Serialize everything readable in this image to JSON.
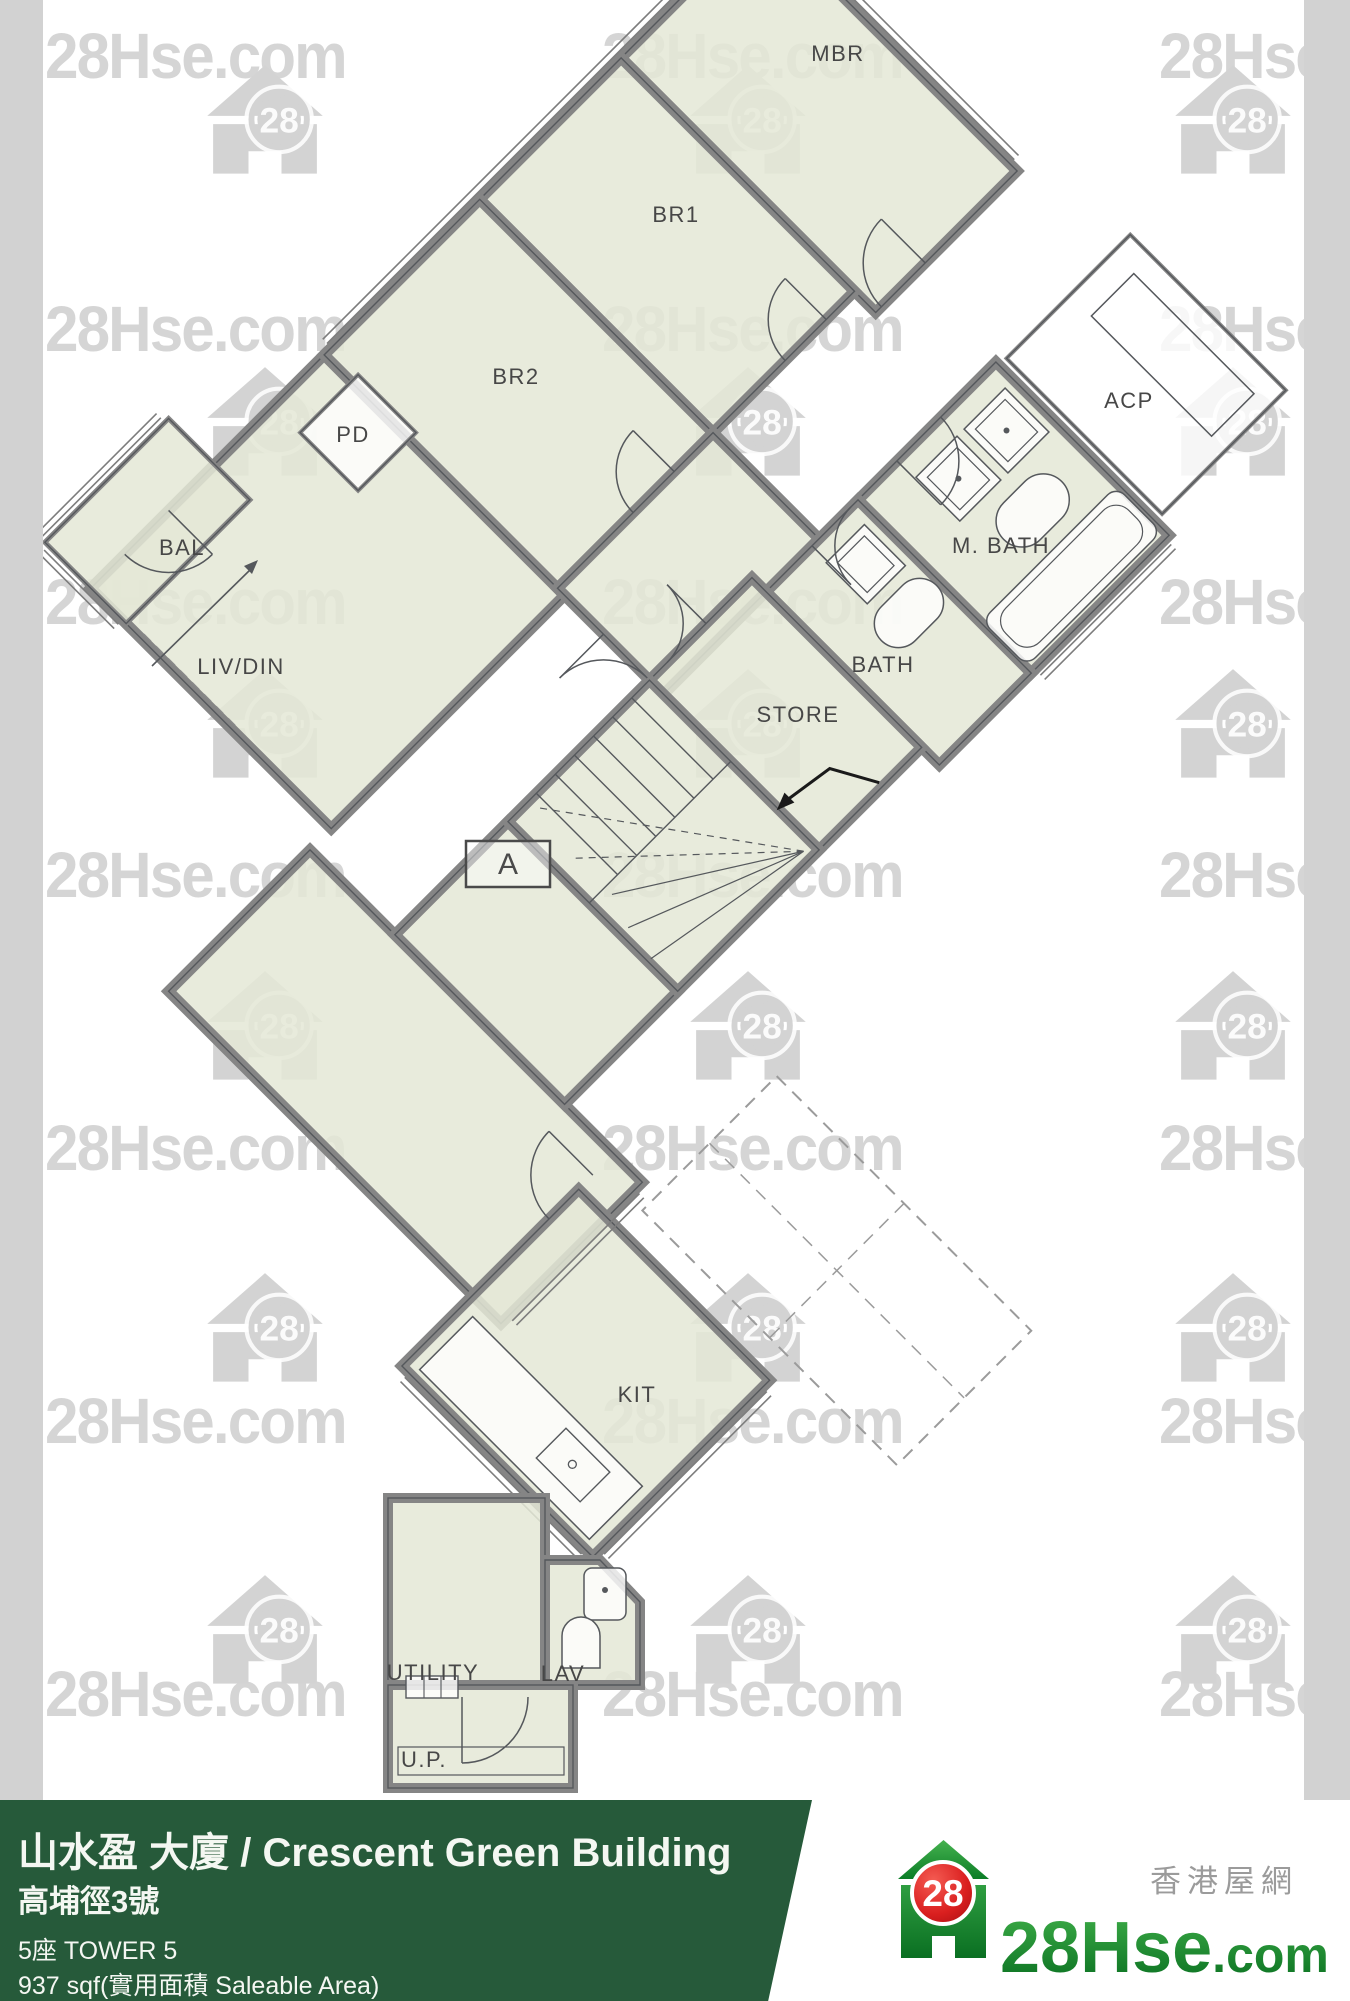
{
  "canvas": {
    "width": 1350,
    "height": 2001
  },
  "watermark": {
    "text": "28Hse.com",
    "badge": "28",
    "text_color": "#d5d5d5",
    "logo_color": "#d3d3d3",
    "text_rows": [
      28,
      301,
      574,
      847,
      1120,
      1393,
      1666
    ],
    "text_cols": [
      45,
      602,
      1159
    ],
    "logo_rows": [
      120,
      422,
      724,
      1026,
      1328,
      1630
    ],
    "logo_cols": [
      265,
      748,
      1233
    ]
  },
  "edge_strips": {
    "color": "#d2d2d2",
    "left_width": 43,
    "right_x": 1304
  },
  "plan": {
    "unit_label": "A",
    "fill_color": "#e4e7d6",
    "wall_color": "#858585",
    "line_color": "#55585c",
    "label_color": "#474747",
    "room_labels": [
      {
        "name": "mbr",
        "label": "MBR",
        "x": 838,
        "y": 53
      },
      {
        "name": "br1",
        "label": "BR1",
        "x": 676,
        "y": 214
      },
      {
        "name": "br2",
        "label": "BR2",
        "x": 516,
        "y": 376
      },
      {
        "name": "pd",
        "label": "PD",
        "x": 353,
        "y": 434
      },
      {
        "name": "acp",
        "label": "ACP",
        "x": 1129,
        "y": 400
      },
      {
        "name": "bal",
        "label": "BAL",
        "x": 182,
        "y": 547
      },
      {
        "name": "m-bath",
        "label": "M. BATH",
        "x": 1001,
        "y": 545
      },
      {
        "name": "liv-din",
        "label": "LIV/DIN",
        "x": 241,
        "y": 666
      },
      {
        "name": "bath",
        "label": "BATH",
        "x": 883,
        "y": 664
      },
      {
        "name": "store",
        "label": "STORE",
        "x": 798,
        "y": 714
      },
      {
        "name": "kit",
        "label": "KIT",
        "x": 637,
        "y": 1394
      },
      {
        "name": "utility",
        "label": "UTILITY",
        "x": 433,
        "y": 1672
      },
      {
        "name": "lav",
        "label": "LAV",
        "x": 563,
        "y": 1673
      },
      {
        "name": "up",
        "label": "U.P.",
        "x": 424,
        "y": 1759
      }
    ]
  },
  "footer": {
    "bg_color": "#265a3a",
    "title": "山水盈 大廈 / Crescent Green Building",
    "address": "高埔徑3號",
    "tower": "5座  TOWER 5",
    "area": "937 sqf(實用面積 Saleable Area)"
  },
  "brand": {
    "chinese_name": "香港屋網",
    "site_name_main": "28Hse",
    "site_name_tld": ".com",
    "badge": "28",
    "green": "#179130",
    "red": "#d9201f"
  }
}
